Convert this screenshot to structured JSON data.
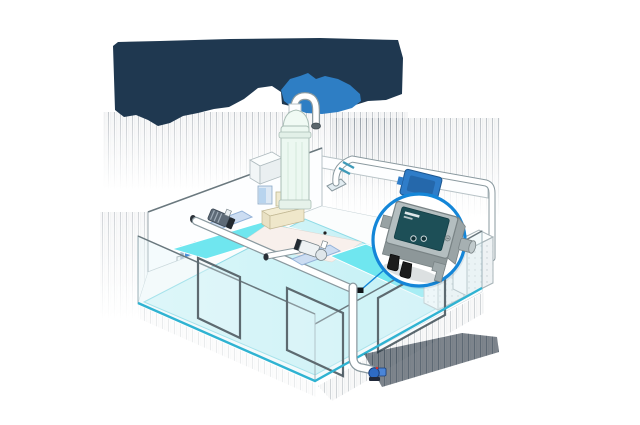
{
  "illustration": {
    "splash": {
      "dark_color": "#1f3850",
      "blue_color": "#2e7ec4"
    },
    "pool": {
      "water_color_left": "#dcf7f9",
      "water_color_mid": "#cdf3f7",
      "water_color_right": "#c2f0f5",
      "shelf_color": "#6fe6ef",
      "edge_color": "#2fb3d2",
      "basin_floor_color": "#f8f0ec"
    },
    "pipes": {
      "fill": "#ffffff",
      "outline": "#8a999f",
      "union_color": "#3f9ab8"
    },
    "tank": {
      "fill": "#ecf8f1",
      "outline": "#a9bdb5"
    },
    "equipment": {
      "pump_base_color": "#ccddf2",
      "pump_motor_dark": "#5d6a77",
      "control_box_color": "#4a90d9",
      "control_box_accent": "#f0c344",
      "bottom_pump_color": "#2e6bc4",
      "cabinet_color": "#f5f8f9",
      "beige_wall_color": "#f3ecd2"
    },
    "shadow_color": "#1d2a36",
    "highlight_device_color": "#2f7dc9"
  },
  "callout": {
    "ring_color": "#1486d8",
    "fill": "#ffffff",
    "device": {
      "body_color": "#9aa4a6",
      "lid_color": "#b4bec0",
      "panel_color": "#1d4f57",
      "gland_color": "#1c1c1c",
      "indicator_count": 2,
      "label_lines": 2
    }
  }
}
